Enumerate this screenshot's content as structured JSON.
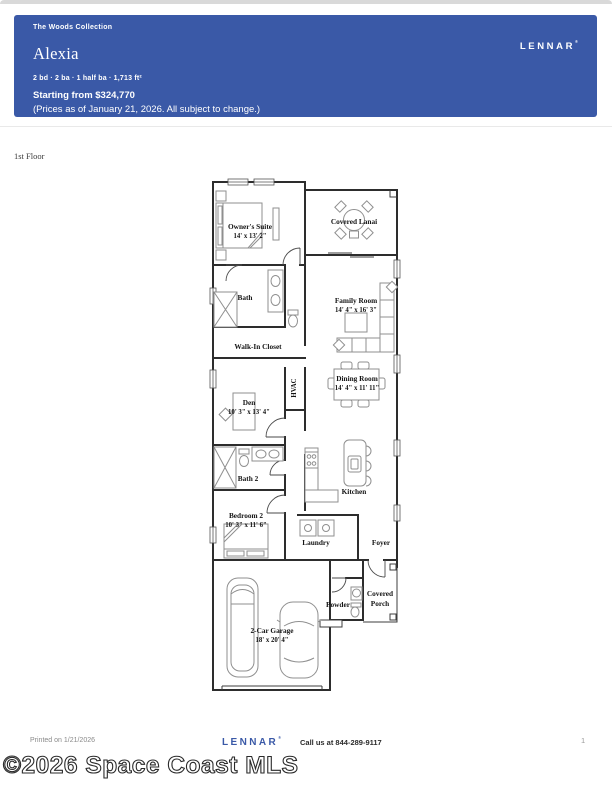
{
  "header": {
    "collection": "The Woods Collection",
    "brand": "LENNAR",
    "brand_mark": "®",
    "plan_name": "Alexia",
    "specs": "2 bd · 2 ba · 1 half ba · 1,713 ft²",
    "price_line": "Starting from $324,770",
    "price_note": "(Prices as of January 21, 2026. All subject to change.)",
    "banner_color": "#3a59a7"
  },
  "floor_label": "1st Floor",
  "floorplan": {
    "rooms": [
      {
        "name": "Owner's Suite",
        "dims": "14' x 13' 2\""
      },
      {
        "name": "Covered Lanai"
      },
      {
        "name": "Bath"
      },
      {
        "name": "Family Room",
        "dims": "14' 4\" x 16' 3\""
      },
      {
        "name": "Walk-In Closet"
      },
      {
        "name": "Dining Room",
        "dims": "14' 4\" x 11' 11\""
      },
      {
        "name": "HVAC"
      },
      {
        "name": "Den",
        "dims": "10' 3\" x 13' 4\""
      },
      {
        "name": "Bath 2"
      },
      {
        "name": "Kitchen"
      },
      {
        "name": "Bedroom 2",
        "dims": "10' 3\" x 11' 6\""
      },
      {
        "name": "Laundry"
      },
      {
        "name": "Foyer"
      },
      {
        "name": "2-Car Garage",
        "dims": "18' x 20' 4\""
      },
      {
        "name": "Powder"
      },
      {
        "name": "Covered Porch",
        "line1": "Covered",
        "line2": "Porch"
      }
    ]
  },
  "footer": {
    "printed": "Printed on 1/21/2026",
    "brand": "LENNAR",
    "brand_mark": "®",
    "call": "Call us at 844-289-9117",
    "page_number": "1"
  },
  "watermark": "©2026 Space Coast MLS"
}
